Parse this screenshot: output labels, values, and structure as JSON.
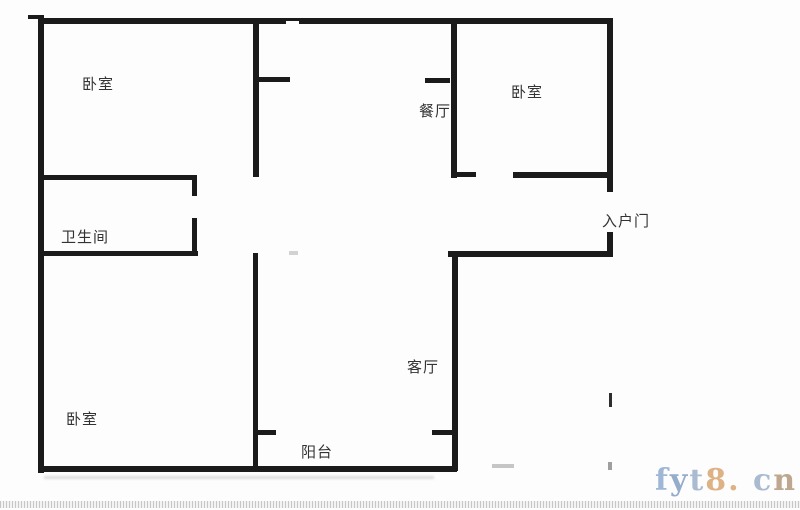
{
  "meta": {
    "type": "apartment-floor-plan"
  },
  "colors": {
    "wall": "#1b1b1b",
    "label": "#333333",
    "background": "#fdfdfd"
  },
  "rooms": {
    "bedroom_top_left": "卧室",
    "bedroom_top_right": "卧室",
    "bedroom_bottom_left": "卧室",
    "bathroom": "卫生间",
    "dining_room": "餐厅",
    "living_room": "客厅",
    "balcony": "阳台",
    "entry_door": "入户门"
  },
  "watermark": {
    "text": "fyt8.cn",
    "chars": [
      {
        "ch": "f",
        "color": "#6e93c2"
      },
      {
        "ch": "y",
        "color": "#5f82b0"
      },
      {
        "ch": "t",
        "color": "#7d97bb"
      },
      {
        "ch": "8",
        "color": "#cd8b45"
      },
      {
        "ch": ".",
        "color": "#cd8b45"
      },
      {
        "ch": " ",
        "color": "#ffffff"
      },
      {
        "ch": "c",
        "color": "#7d97bb"
      },
      {
        "ch": "n",
        "color": "#9c7a55"
      }
    ]
  }
}
